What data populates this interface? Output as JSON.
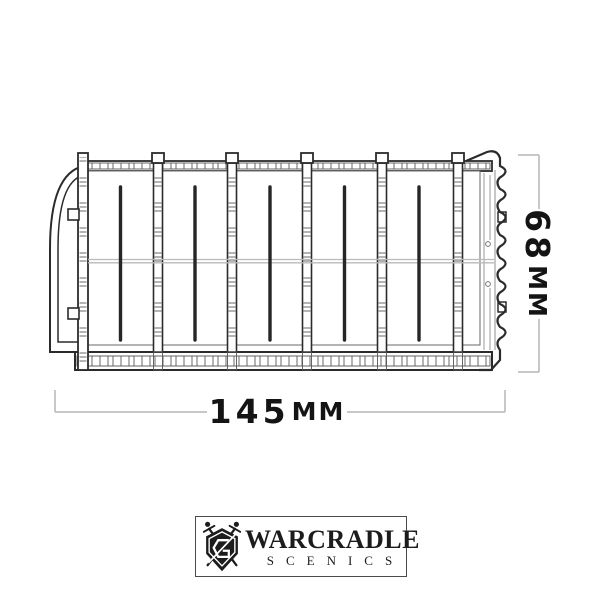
{
  "drawing": {
    "subject": "shipping-container side elevation technical drawing",
    "style": "line art",
    "line_color": "#2b2b2b",
    "detail_color": "#8f8f8f",
    "seam_color": "#b9b9b9",
    "bracket_color": "#b5b5b5",
    "background": "#ffffff"
  },
  "dimensions": {
    "width": {
      "value": "145",
      "unit": "MM"
    },
    "height": {
      "value": "68",
      "unit": "MM"
    }
  },
  "logo": {
    "brand": "WARCRADLE",
    "sub_brand": "SCENICS",
    "icon": "shield-with-crossed-swords",
    "text_color": "#1c1c1c"
  }
}
